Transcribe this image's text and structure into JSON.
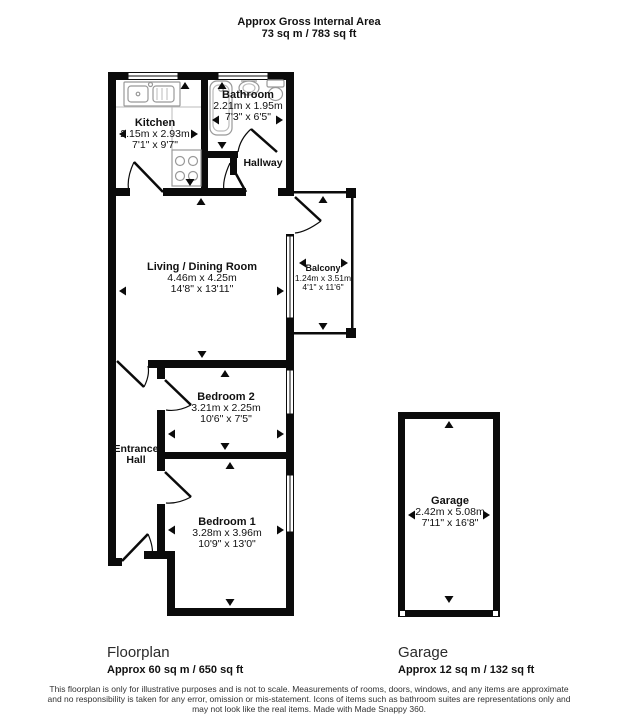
{
  "header": {
    "title": "Approx Gross Internal Area",
    "area": "73 sq m / 783 sq ft"
  },
  "rooms": {
    "kitchen": {
      "name": "Kitchen",
      "metric": "2.15m x 2.93m",
      "imperial": "7'1\" x 9'7\""
    },
    "bathroom": {
      "name": "Bathroom",
      "metric": "2.21m x 1.95m",
      "imperial": "7'3\" x 6'5\""
    },
    "hallway": {
      "name": "Hallway"
    },
    "living": {
      "name": "Living / Dining Room",
      "metric": "4.46m x 4.25m",
      "imperial": "14'8\" x 13'11\""
    },
    "balcony": {
      "name": "Balcony",
      "metric": "1.24m x 3.51m",
      "imperial": "4'1\" x 11'6\""
    },
    "bedroom2": {
      "name": "Bedroom 2",
      "metric": "3.21m x 2.25m",
      "imperial": "10'6\" x 7'5\""
    },
    "entrance_hall": {
      "line1": "Entrance",
      "line2": "Hall"
    },
    "bedroom1": {
      "name": "Bedroom 1",
      "metric": "3.28m x 3.96m",
      "imperial": "10'9\" x 13'0\""
    },
    "garage": {
      "name": "Garage",
      "metric": "2.42m x 5.08m",
      "imperial": "7'11\" x 16'8\""
    }
  },
  "footer": {
    "floorplan_title": "Floorplan",
    "floorplan_area": "Approx 60 sq m / 650 sq ft",
    "garage_title": "Garage",
    "garage_area": "Approx 12 sq m / 132 sq ft"
  },
  "disclaimer": {
    "line1": "This floorplan is only for illustrative purposes and is not to scale. Measurements of rooms, doors, windows, and any items are approximate",
    "line2": "and no responsibility is taken for any error, omission or mis-statement. Icons of items such as bathroom suites are representations only and",
    "line3": "may not look like the real items. Made with Made Snappy 360."
  },
  "colors": {
    "wall": "#0b0b0b",
    "fixture": "#999999",
    "text": "#111111",
    "background": "#ffffff"
  }
}
